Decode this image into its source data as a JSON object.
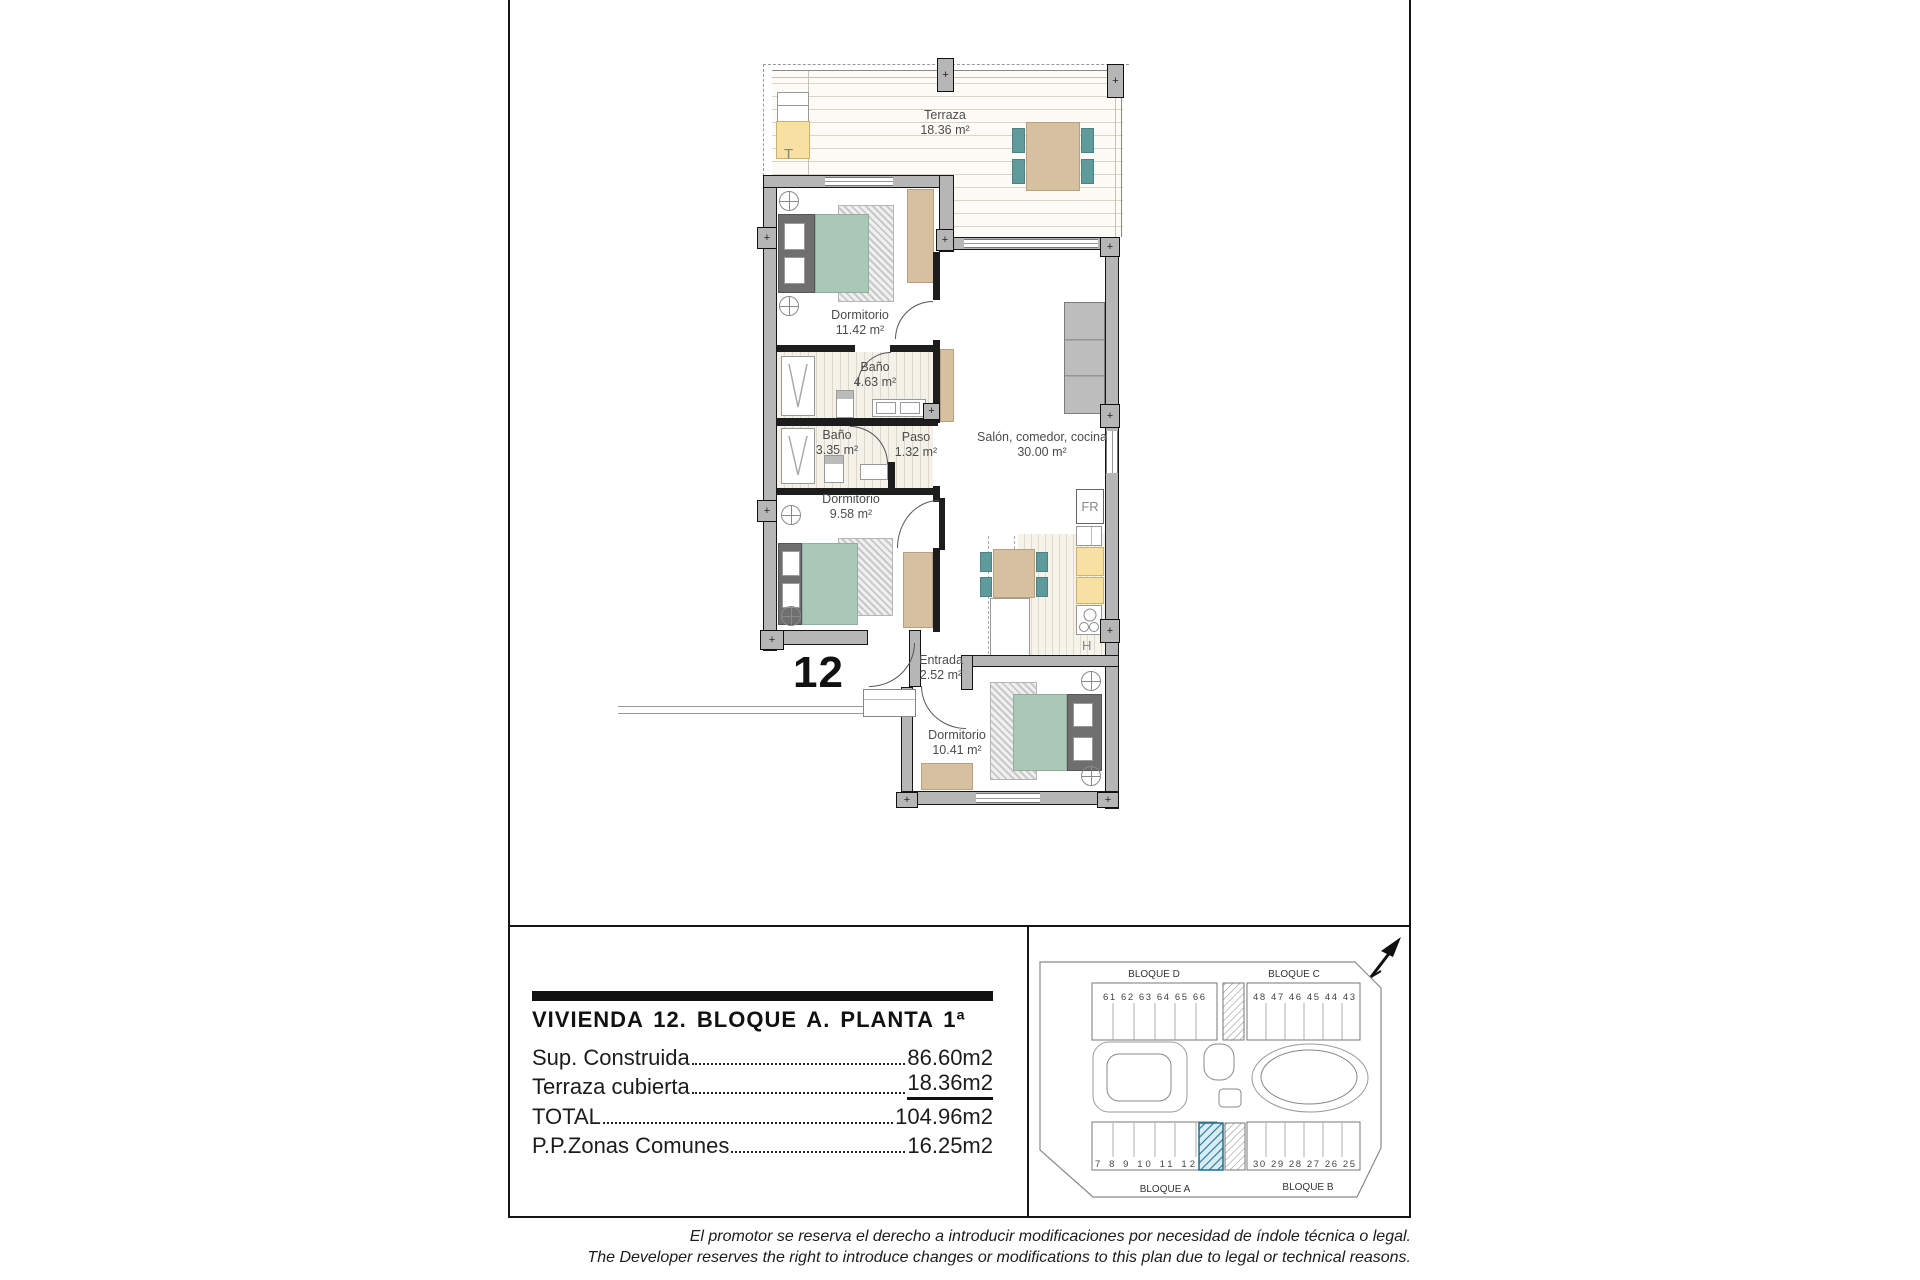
{
  "plan": {
    "unit_label": "12",
    "post_marker": "+",
    "terrace_marker": "T",
    "fridge_label": "FR",
    "hob_label": "H",
    "rooms": {
      "terraza": {
        "name": "Terraza",
        "area": "18.36 m²"
      },
      "dorm1": {
        "name": "Dormitorio",
        "area": "11.42 m²"
      },
      "bano1": {
        "name": "Baño",
        "area": "4.63 m²"
      },
      "bano2": {
        "name": "Baño",
        "area": "3.35 m²"
      },
      "paso": {
        "name": "Paso",
        "area": "1.32 m²"
      },
      "salon": {
        "name": "Salón, comedor, cocina",
        "area": "30.00 m²"
      },
      "dorm2": {
        "name": "Dormitorio",
        "area": "9.58 m²"
      },
      "entrada": {
        "name": "Entrada",
        "area": "2.52 m²"
      },
      "dorm3": {
        "name": "Dormitorio",
        "area": "10.41 m²"
      }
    }
  },
  "info_panel": {
    "title": "VIVIENDA 12. BLOQUE A. PLANTA 1ª",
    "rows": [
      {
        "label": "Sup. Construida",
        "value": "86.60m2"
      },
      {
        "label": "Terraza cubierta",
        "value": "18.36m2"
      },
      {
        "label": "TOTAL",
        "value": "104.96m2"
      },
      {
        "label": "P.P.Zonas Comunes",
        "value": "16.25m2"
      }
    ]
  },
  "site_plan": {
    "block_d": "BLOQUE D",
    "block_c": "BLOQUE C",
    "block_a": "BLOQUE A",
    "block_b": "BLOQUE B",
    "units_d": "61 62 63 64 65 66",
    "units_c": "48 47 46 45 44 43",
    "units_a": "7 8 9 10 11 12",
    "units_b": "30 29 28 27 26 25",
    "highlight_color": "#2a7d9c"
  },
  "disclaimer": {
    "es": "El promotor se reserva el derecho a introducir modificaciones por necesidad de índole técnica o legal.",
    "en": "The Developer reserves the right to introduce changes or modifications to this plan due to legal or technical reasons."
  }
}
